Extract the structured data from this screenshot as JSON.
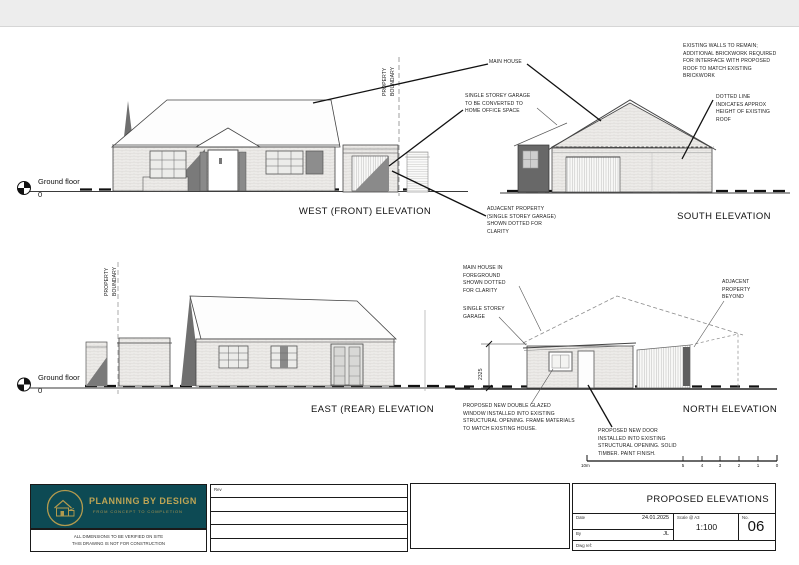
{
  "sheet": {
    "accent_teal": "#0d4a54",
    "accent_gold": "#b29a4e",
    "line_color": "#1a1a1a"
  },
  "elevations": {
    "west": {
      "title": "WEST (FRONT) ELEVATION"
    },
    "south": {
      "title": "SOUTH ELEVATION"
    },
    "east": {
      "title": "EAST (REAR) ELEVATION"
    },
    "north": {
      "title": "NORTH ELEVATION"
    }
  },
  "datum": {
    "label": "Ground floor",
    "value": "0"
  },
  "labels": {
    "property_boundary": "PROPERTY BOUNDARY",
    "main_house": "MAIN HOUSE",
    "garage_conversion": "SINGLE STOREY GARAGE TO BE CONVERTED TO HOME OFFICE SPACE",
    "existing_walls": "EXISTING WALLS TO REMAIN; ADDITIONAL BRICKWORK REQUIRED FOR INTERFACE WITH PROPOSED ROOF TO MATCH EXISTING BRICKWORK",
    "dotted_line": "DOTTED LINE INDICATES APPROX HEIGHT OF EXISTING ROOF",
    "adjacent_garage": "ADJACENT PROPERTY (SINGLE STOREY GARAGE) SHOWN DOTTED FOR CLARITY",
    "main_house_foreground": "MAIN HOUSE IN FOREGROUND SHOWN DOTTED FOR CLARITY",
    "single_storey_garage": "SINGLE STOREY GARAGE",
    "adjacent_beyond": "ADJACENT PROPERTY BEYOND",
    "new_window": "PROPOSED NEW DOUBLE GLAZED WINDOW INSTALLED INTO EXISTING STRUCTURAL OPENING. FRAME MATERIALS TO MATCH EXISTING HOUSE.",
    "new_door": "PROPOSED NEW DOOR INSTALLED INTO EXISTING STRUCTURAL OPENING. SOLID TIMBER. PAINT FINISH."
  },
  "dimensions": {
    "garage_height_mm": "2325"
  },
  "scale_bar": {
    "left_label": "10m",
    "ticks": [
      "5",
      "4",
      "3",
      "2",
      "1",
      "0"
    ]
  },
  "title_block": {
    "logo_title": "PLANNING BY DESIGN",
    "logo_subtitle": "FROM CONCEPT TO COMPLETION",
    "disclaimer_line1": "ALL DIMENSIONS TO BE VERIFIED ON SITE",
    "disclaimer_line2": "THIS DRAWING IS NOT FOR CONSTRUCTION",
    "rev_label": "Rev",
    "drawing_title": "PROPOSED ELEVATIONS",
    "date_label": "Date",
    "date_value": "24.01.2025",
    "by_label": "By",
    "by_value": "JL",
    "scale_label": "Scale @ A3",
    "scale_value": "1:100",
    "no_label": "No.",
    "no_value": "06",
    "dwg_ref_label": "Dwg ref:"
  }
}
